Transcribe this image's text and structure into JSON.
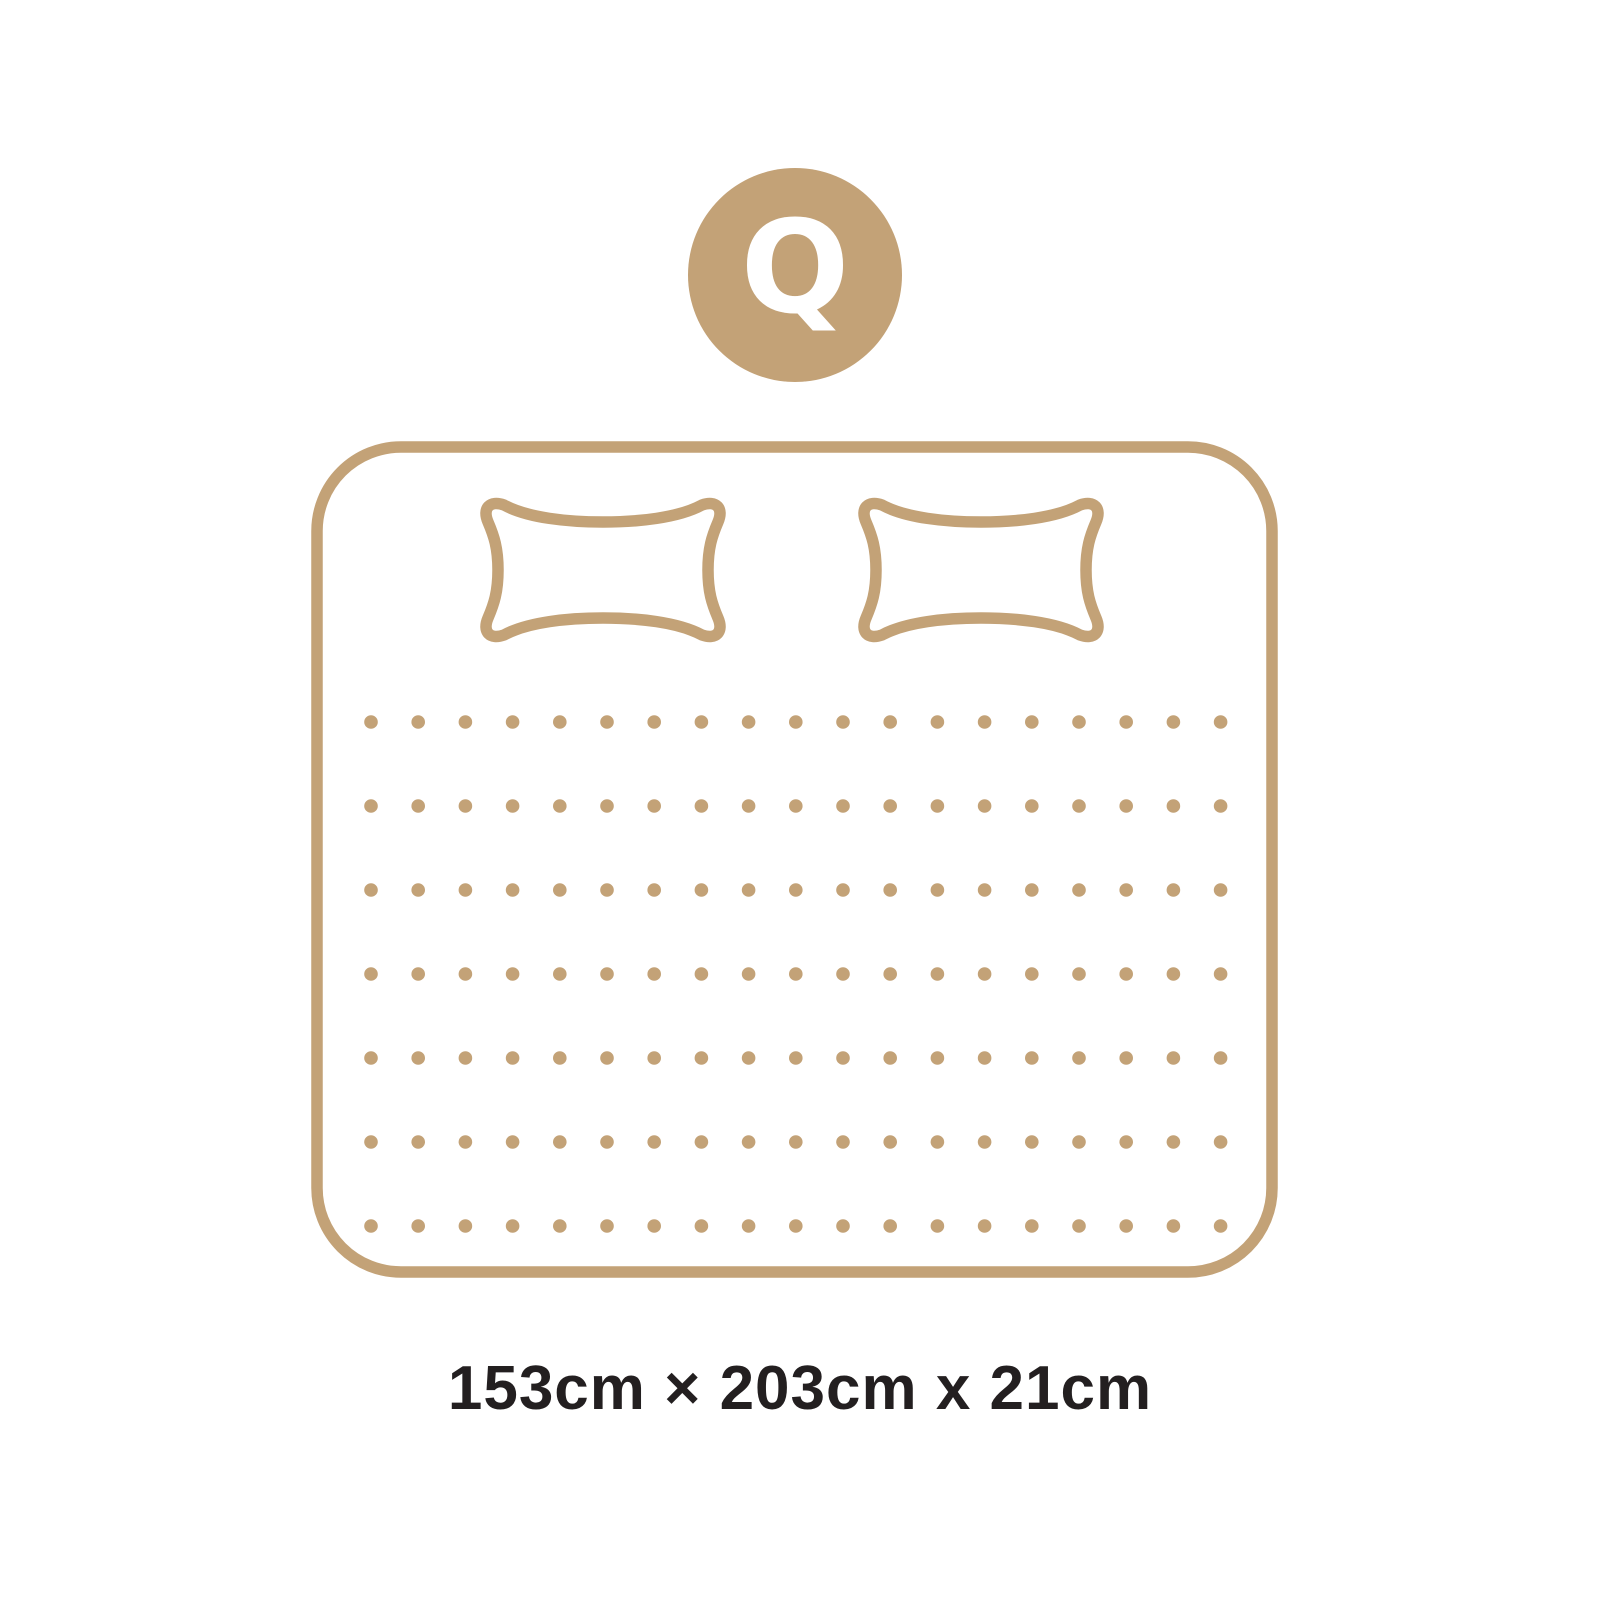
{
  "colors": {
    "accent": "#C3A277",
    "badge_text": "#FFFFFF",
    "caption_text": "#231F20",
    "background": "#FFFFFF"
  },
  "badge": {
    "label": "Q"
  },
  "diagram": {
    "name": "queen-mattress-top-view",
    "icons": [
      "size-badge-circle",
      "mattress-outline",
      "pillow-icon",
      "pillow-icon",
      "dot-grid"
    ],
    "pillow_count": 2,
    "dot_grid": {
      "rows": 7,
      "columns": 19
    }
  },
  "caption": {
    "text": "153cm × 203cm x 21cm"
  }
}
